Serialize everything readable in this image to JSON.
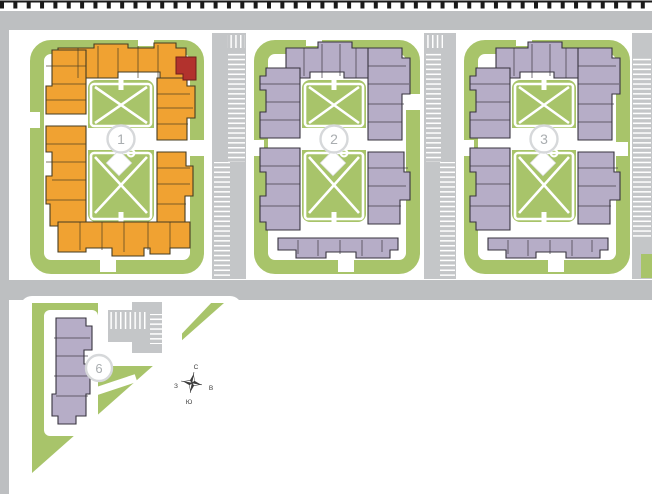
{
  "map": {
    "buildings": [
      {
        "number": "1",
        "highlighted": true
      },
      {
        "number": "2",
        "highlighted": false
      },
      {
        "number": "3",
        "highlighted": false
      },
      {
        "number": "6",
        "highlighted": false
      }
    ],
    "compass": {
      "north": "С",
      "east": "В",
      "south": "Ю",
      "west": "З"
    },
    "colors": {
      "building_1": "#F0A232",
      "building_1_outline": "#463C22",
      "building_other": "#B6ADC7",
      "building_other_outline": "#38343F",
      "selected_unit": "#B2322D",
      "selected_unit_outline": "#6E1F1C",
      "lawn": "#A8C46A",
      "road": "#BDBFC1",
      "parking": "#C4C6C8",
      "badge_border": "#D6D8DA",
      "badge_text": "#A9ADB0",
      "boundary": "#1A1A1A",
      "compass_ink": "#3A3A3A"
    }
  }
}
